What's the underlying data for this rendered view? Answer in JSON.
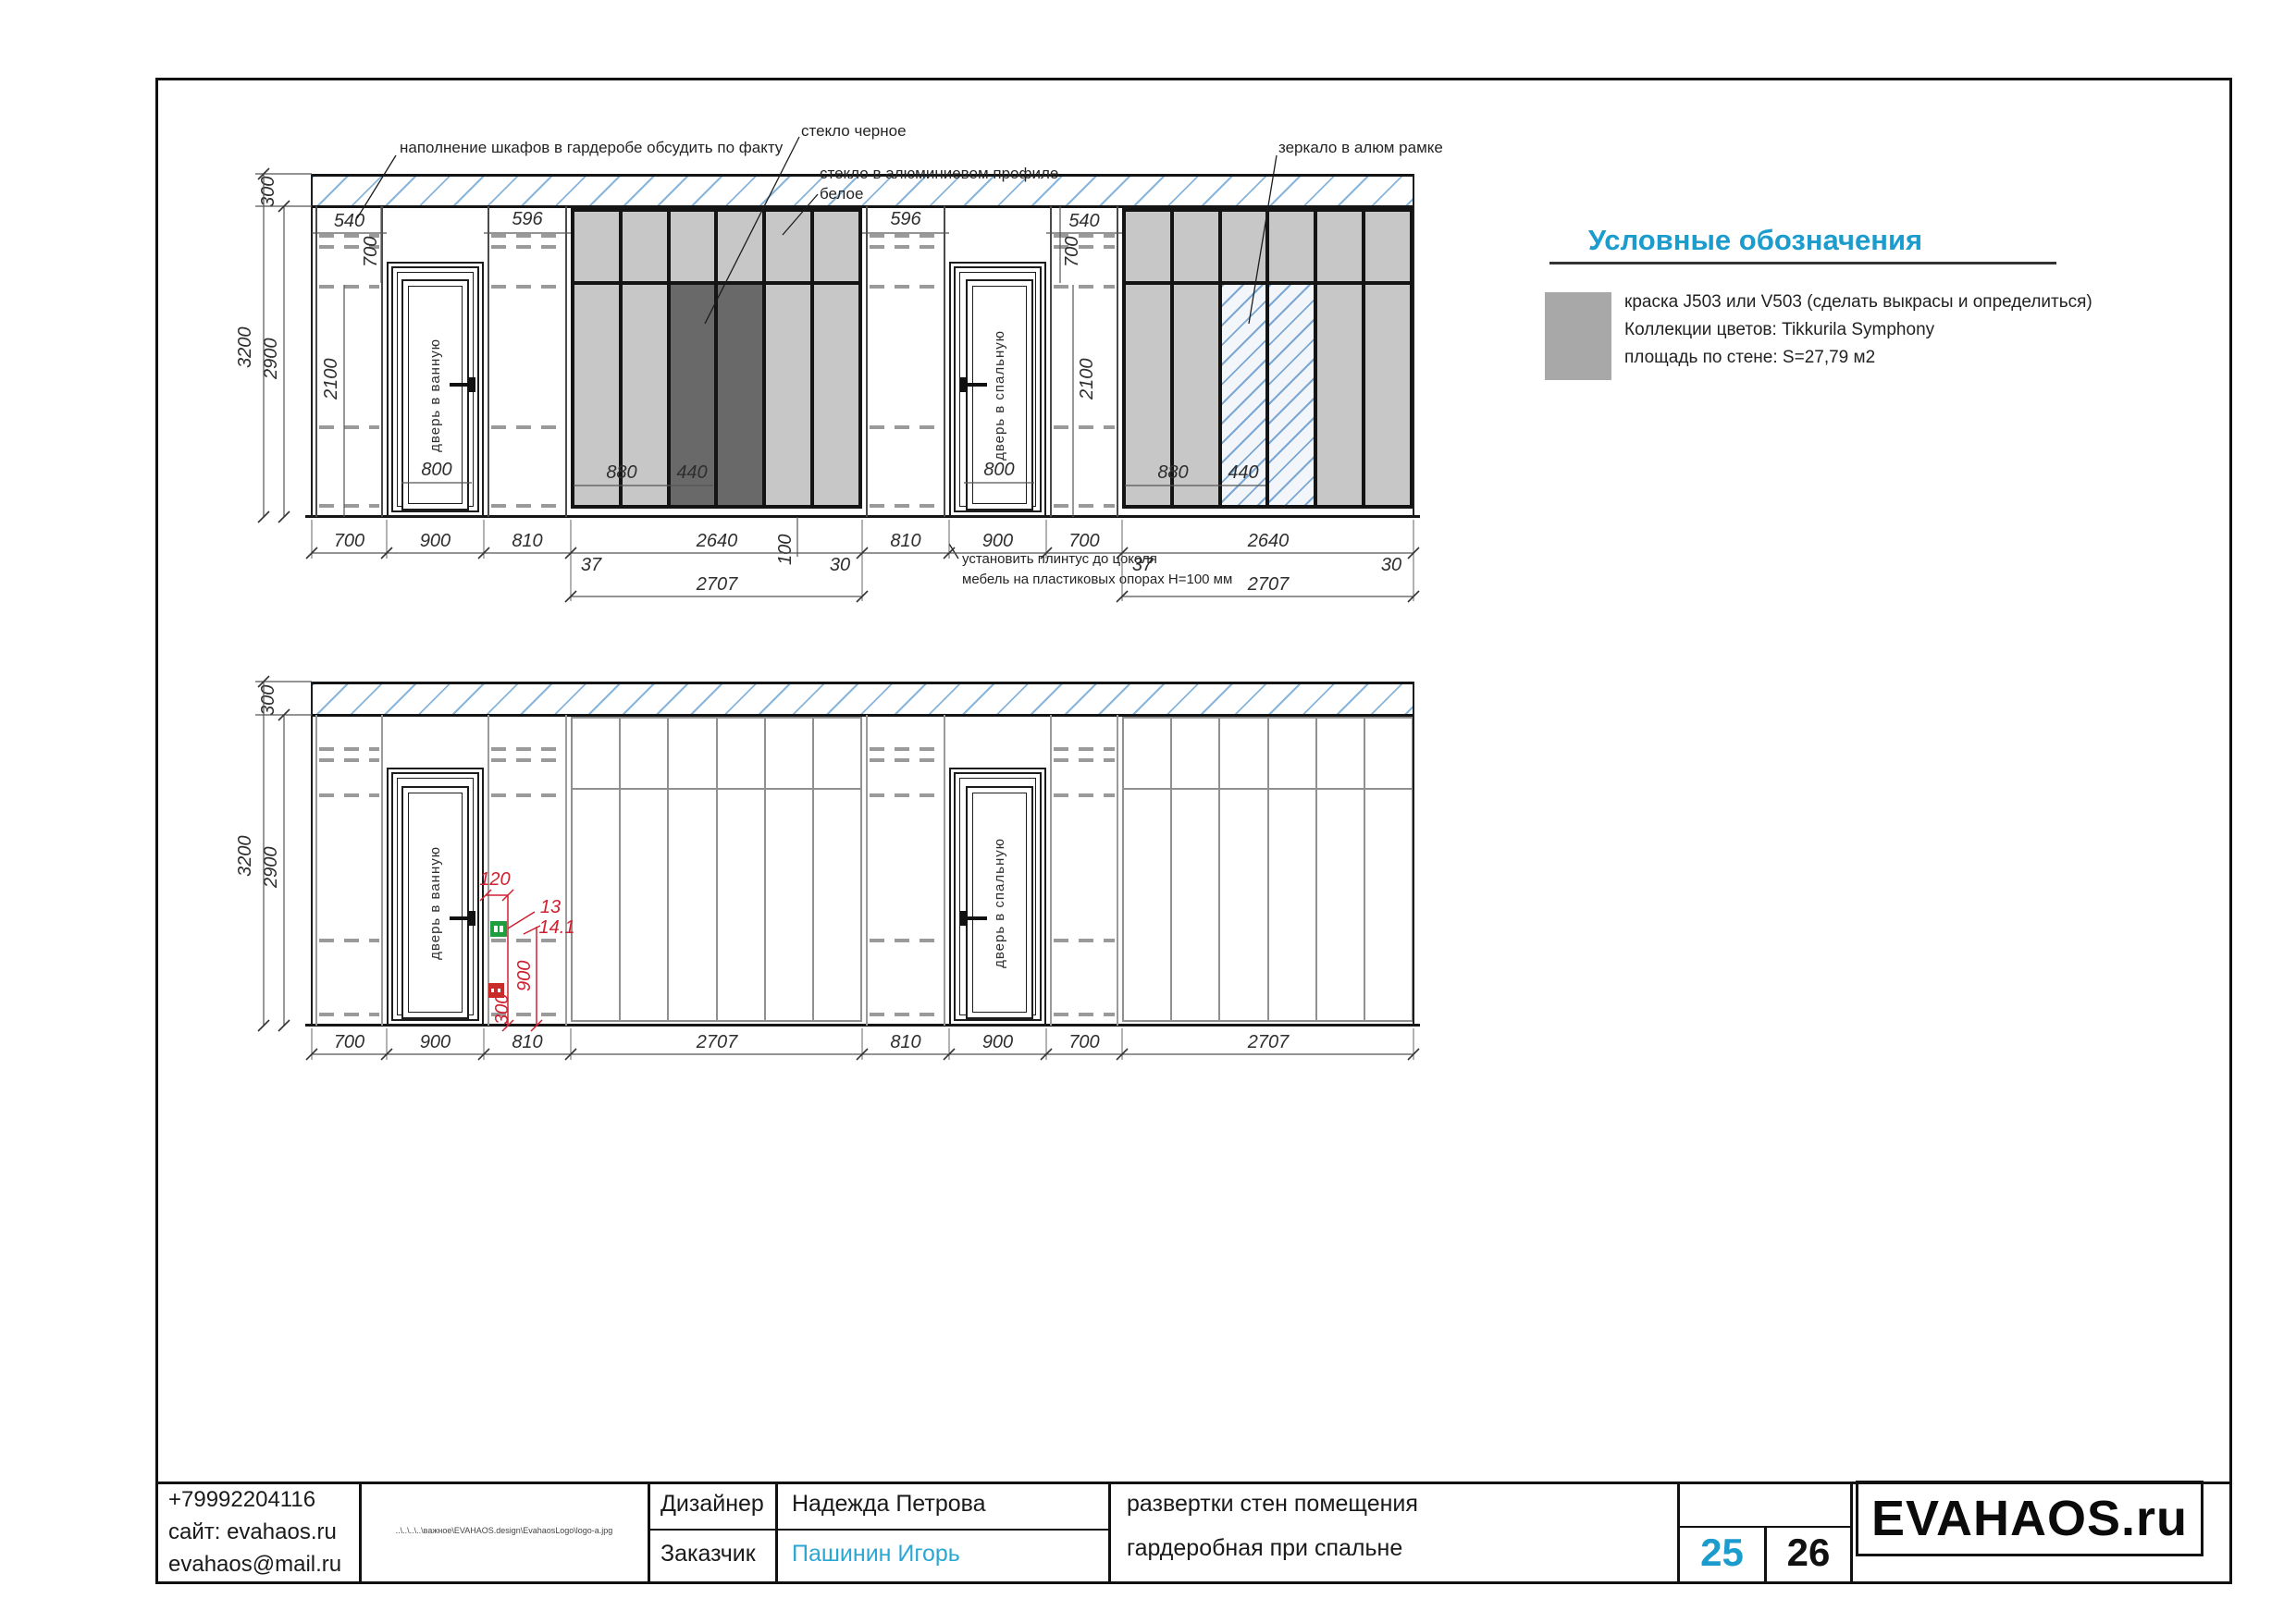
{
  "annotations": {
    "fill_note": "наполнение шкафов в гардеробе обсудить по факту",
    "glass_black": "стекло черное",
    "glass_white_1": "стекло в алюминиевом профиле",
    "glass_white_2": "белое",
    "mirror": "зеркало в алюм рамке",
    "plinth_1": "установить плинтус до цоколя",
    "plinth_2": "мебель на пластиковых опорах H=100 мм"
  },
  "legend": {
    "title": "Условные обозначения",
    "swatch_color": "#a8a8a8",
    "line1": "краска J503 или V503 (сделать выкрасы и определиться)",
    "line2": "Коллекции цветов: Tikkurila Symphony",
    "line3": "площадь по стене: S=27,79 м2"
  },
  "doors": {
    "bath": "дверь в ванную",
    "bedroom": "дверь в спальную"
  },
  "elev_top": {
    "h300": "300",
    "h3200": "3200",
    "h2900": "2900",
    "p1_540": "540",
    "p2_596": "596",
    "p3_596": "596",
    "p4_540": "540",
    "d1_700": "700",
    "d2_700": "700",
    "d1_2100": "2100",
    "d2_2100": "2100",
    "d1_800": "800",
    "d2_800": "800",
    "w1_880": "880",
    "w1_440": "440",
    "w2_880": "880",
    "w2_440": "440",
    "b_700a": "700",
    "b_900a": "900",
    "b_810a": "810",
    "b_2640a": "2640",
    "b_100": "100",
    "b_37a": "37",
    "b_30a": "30",
    "b_2707a": "2707",
    "b_810b": "810",
    "b_900b": "900",
    "b_700b": "700",
    "b_37b": "37",
    "b_2640b": "2640",
    "b_30b": "30",
    "b_2707b": "2707"
  },
  "elev_bottom": {
    "h300": "300",
    "h3200": "3200",
    "h2900": "2900",
    "b_700a": "700",
    "b_900a": "900",
    "b_810a": "810",
    "b_2707a": "2707",
    "b_810b": "810",
    "b_900b": "900",
    "b_700b": "700",
    "b_2707b": "2707",
    "e_120": "120",
    "e_13": "13",
    "e_141": "14.1",
    "e_900": "900",
    "e_300": "300"
  },
  "titleblock": {
    "phone": "+79992204116",
    "site": "сайт: evahaos.ru",
    "email": "evahaos@mail.ru",
    "path": "..\\..\\..\\..\\важное\\EVAHAOS.design\\EvahaosLogo\\logo-a.jpg",
    "designer_label": "Дизайнер",
    "designer_name": "Надежда Петрова",
    "client_label": "Заказчик",
    "client_name": "Пашинин Игорь",
    "project_1": "развертки стен помещения",
    "project_2": "гардеробная при спальне",
    "page_current": "25",
    "page_total": "26",
    "logo": "EVAHAOS.ru"
  },
  "colors": {
    "accent_cyan": "#1b9ccd",
    "hatch_blue": "#88b5dc",
    "panel_light": "#c7c7c7",
    "panel_dark": "#696969",
    "annotation_red": "#cf2030",
    "switch_green": "#1e9e3e",
    "swatch_gray": "#a8a8a8"
  }
}
